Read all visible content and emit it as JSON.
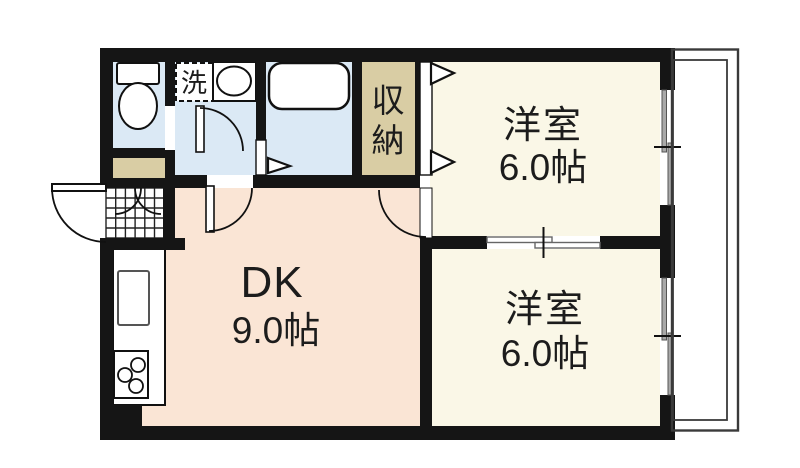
{
  "floorplan": {
    "type": "japanese-apartment-floorplan",
    "rooms": {
      "dk": {
        "label": "DK",
        "size": "9.0帖"
      },
      "room_top": {
        "label": "洋室",
        "size": "6.0帖"
      },
      "room_bottom": {
        "label": "洋室",
        "size": "6.0帖"
      },
      "storage": {
        "label": "収納",
        "char1": "収",
        "char2": "納"
      },
      "laundry": {
        "label": "洗"
      }
    },
    "colors": {
      "wall": "#151515",
      "room_floor": "#faf7e7",
      "dk_floor": "#fae5d5",
      "wet_floor": "#dbe9f5",
      "closet": "#d9cda4",
      "fixture_fill": "#ffffff",
      "window_pane": "#a9a9a9",
      "balcony_line": "#3a3a3a"
    }
  }
}
